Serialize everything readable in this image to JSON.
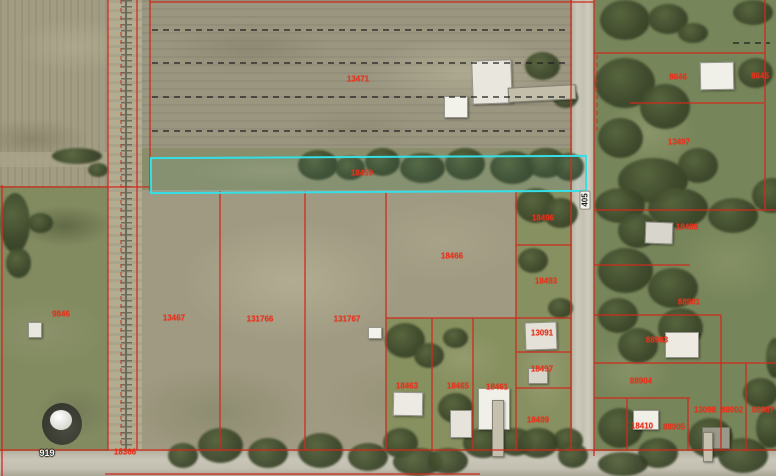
{
  "map": {
    "type": "aerial-parcel-map",
    "colors": {
      "parcel_line": "#cf2b1d",
      "highlight": "#35dfe6",
      "parcel_label": "#e8311c",
      "road_label_bg": "#f2f1ea"
    },
    "selected_parcel_id": "18459",
    "parcel_labels": [
      {
        "id": "13471",
        "x": 358,
        "y": 79
      },
      {
        "id": "18459",
        "x": 362,
        "y": 173
      },
      {
        "id": "13467",
        "x": 174,
        "y": 318
      },
      {
        "id": "131766",
        "x": 260,
        "y": 319
      },
      {
        "id": "131767",
        "x": 347,
        "y": 319
      },
      {
        "id": "18466",
        "x": 452,
        "y": 256
      },
      {
        "id": "9846",
        "x": 61,
        "y": 314
      },
      {
        "id": "18366",
        "x": 125,
        "y": 452
      },
      {
        "id": "18463",
        "x": 407,
        "y": 386
      },
      {
        "id": "18465",
        "x": 458,
        "y": 386
      },
      {
        "id": "18461",
        "x": 497,
        "y": 387
      },
      {
        "id": "18496",
        "x": 543,
        "y": 218
      },
      {
        "id": "18493",
        "x": 546,
        "y": 281
      },
      {
        "id": "13091",
        "x": 542,
        "y": 333
      },
      {
        "id": "18497",
        "x": 542,
        "y": 369
      },
      {
        "id": "18499",
        "x": 538,
        "y": 420
      },
      {
        "id": "8646",
        "x": 678,
        "y": 77
      },
      {
        "id": "8645",
        "x": 760,
        "y": 76
      },
      {
        "id": "13497",
        "x": 679,
        "y": 142
      },
      {
        "id": "18498",
        "x": 687,
        "y": 227
      },
      {
        "id": "88901",
        "x": 689,
        "y": 302
      },
      {
        "id": "88903",
        "x": 657,
        "y": 340
      },
      {
        "id": "88904",
        "x": 641,
        "y": 381
      },
      {
        "id": "13098",
        "x": 705,
        "y": 410
      },
      {
        "id": "88902",
        "x": 732,
        "y": 410
      },
      {
        "id": "88907",
        "x": 763,
        "y": 410
      },
      {
        "id": "18410",
        "x": 642,
        "y": 426
      },
      {
        "id": "88905",
        "x": 674,
        "y": 427
      }
    ],
    "road_labels": [
      {
        "text": "405",
        "x": 585,
        "y": 200,
        "vertical": true
      },
      {
        "text": "919",
        "x": 47,
        "y": 453,
        "vertical": false
      }
    ]
  }
}
